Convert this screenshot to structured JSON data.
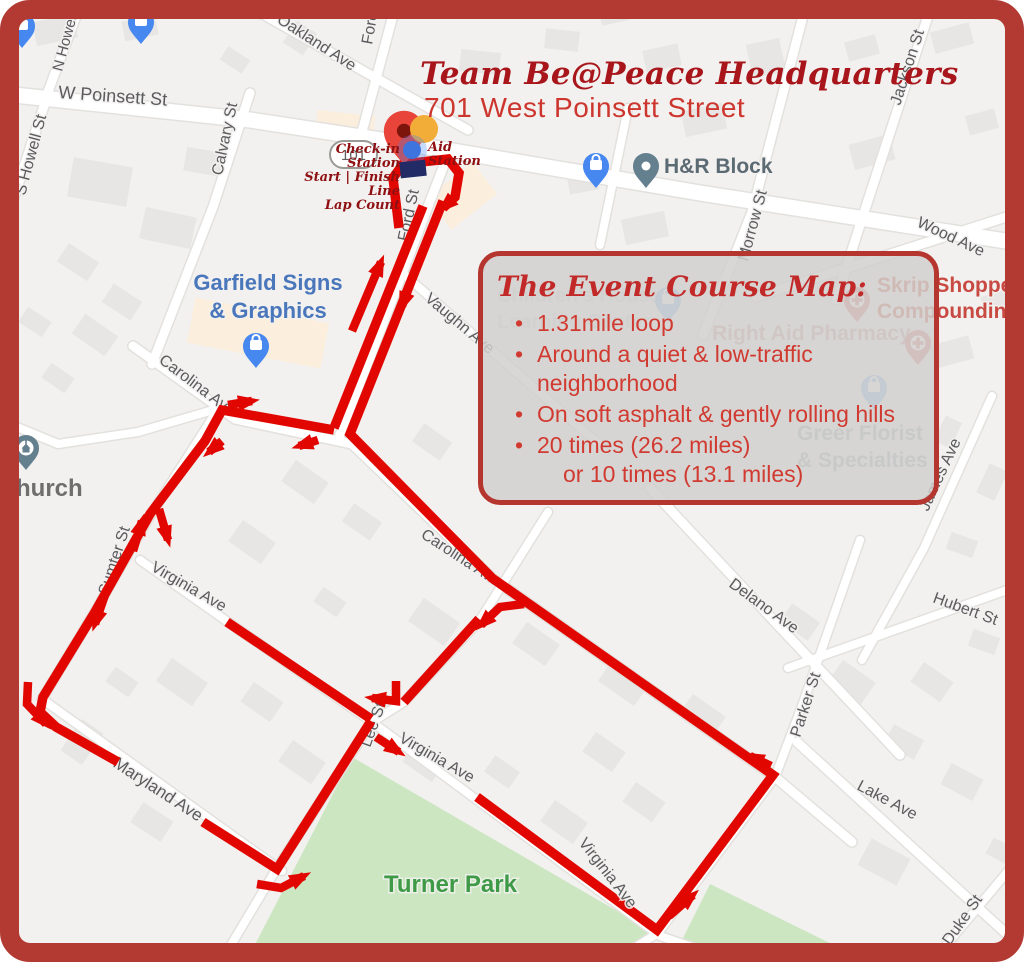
{
  "frame": {
    "border_color": "#b23a32"
  },
  "header": {
    "title": "Team Be@Peace Headquarters",
    "subtitle": "701 West Poinsett Street"
  },
  "start_area": {
    "aid_station_lines": [
      "Aid",
      "Station"
    ],
    "checkin_lines": [
      "Check-in Station",
      "Start | Finish Line",
      "Lap Count"
    ]
  },
  "course_box": {
    "title": "The Event Course Map:",
    "bullets": [
      {
        "text": "1.31mile loop"
      },
      {
        "text": "Around a quiet & low-traffic neighborhood"
      },
      {
        "text": "On soft asphalt & gently rolling hills"
      },
      {
        "text": "20 times (26.2 miles)",
        "cont": "or 10 times (13.1 miles)"
      }
    ],
    "accent_color": "#b5362f",
    "text_color": "#d13a30"
  },
  "map": {
    "background": "#f2f1ef",
    "route_color": "#e10600",
    "route_shield": "101",
    "park_color": "#cbe6c1",
    "street_labels": [
      {
        "t": "W Poinsett St",
        "x": 58,
        "y": 98,
        "r": 4,
        "s": 18
      },
      {
        "t": "Oakland Ave",
        "x": 276,
        "y": 22,
        "r": 33,
        "s": 16
      },
      {
        "t": "Fore",
        "x": 372,
        "y": 45,
        "r": -80,
        "s": 16
      },
      {
        "t": "N Howell",
        "x": 62,
        "y": 72,
        "r": -75,
        "s": 15
      },
      {
        "t": "S Howell St",
        "x": 25,
        "y": 196,
        "r": -75,
        "s": 16
      },
      {
        "t": "Calvary St",
        "x": 222,
        "y": 176,
        "r": -78,
        "s": 16
      },
      {
        "t": "Jackson St",
        "x": 900,
        "y": 106,
        "r": -72,
        "s": 16
      },
      {
        "t": "Wood Ave",
        "x": 916,
        "y": 226,
        "r": 25,
        "s": 16
      },
      {
        "t": "Morrow St",
        "x": 748,
        "y": 262,
        "r": -75,
        "s": 16
      },
      {
        "t": "Ford St",
        "x": 408,
        "y": 242,
        "r": -78,
        "s": 16
      },
      {
        "t": "Vaughn Ave",
        "x": 424,
        "y": 300,
        "r": 40,
        "s": 16
      },
      {
        "t": "Carolina Ave",
        "x": 158,
        "y": 362,
        "r": 37,
        "s": 16
      },
      {
        "t": "Carolina Ave",
        "x": 420,
        "y": 537,
        "r": 33,
        "s": 16
      },
      {
        "t": "Sumter St",
        "x": 108,
        "y": 596,
        "r": -72,
        "s": 16
      },
      {
        "t": "Virginia Ave",
        "x": 150,
        "y": 570,
        "r": 30,
        "s": 16
      },
      {
        "t": "Virginia Ave",
        "x": 398,
        "y": 741,
        "r": 30,
        "s": 16
      },
      {
        "t": "Virginia Ave",
        "x": 578,
        "y": 843,
        "r": 52,
        "s": 16,
        "top": true
      },
      {
        "t": "Lee St",
        "x": 370,
        "y": 748,
        "r": -70,
        "s": 16
      },
      {
        "t": "Maryland Ave",
        "x": 112,
        "y": 766,
        "r": 33,
        "s": 17
      },
      {
        "t": "Delano Ave",
        "x": 728,
        "y": 586,
        "r": 36,
        "s": 16
      },
      {
        "t": "Hubert St",
        "x": 932,
        "y": 602,
        "r": 20,
        "s": 16
      },
      {
        "t": "Parker St",
        "x": 800,
        "y": 738,
        "r": -72,
        "s": 16
      },
      {
        "t": "Lake Ave",
        "x": 856,
        "y": 789,
        "r": 28,
        "s": 16
      },
      {
        "t": "Duke St",
        "x": 950,
        "y": 946,
        "r": -55,
        "s": 16
      },
      {
        "t": "James Ave",
        "x": 928,
        "y": 512,
        "r": -65,
        "s": 16
      }
    ],
    "poi_labels": [
      {
        "name": "garfield-signs",
        "lines": [
          "Garfield Signs",
          "& Graphics"
        ],
        "x": 268,
        "y": 290,
        "s": 22,
        "c": "#4a77bb",
        "align": "middle",
        "lh": 28
      },
      {
        "name": "hr-block",
        "lines": [
          "H&R Block"
        ],
        "x": 664,
        "y": 173,
        "s": 21,
        "c": "#5c6a74"
      },
      {
        "name": "church",
        "lines": [
          "hurch"
        ],
        "x": 16,
        "y": 496,
        "s": 24,
        "c": "#6e6e6e"
      },
      {
        "name": "turner-park",
        "lines": [
          "Turner Park"
        ],
        "x": 384,
        "y": 892,
        "s": 24,
        "c": "#3f9a47"
      },
      {
        "name": "skrip-shoppe",
        "lines": [
          "Skrip Shoppe",
          "Compounding"
        ],
        "x": 877,
        "y": 292,
        "s": 21,
        "c": "#c94a43",
        "lh": 26
      },
      {
        "name": "right-aid",
        "lines": [
          "Right Aid Pharmacy"
        ],
        "x": 712,
        "y": 340,
        "s": 21,
        "c": "#c5908b",
        "o": 0.85
      },
      {
        "name": "greer-florist",
        "lines": [
          "Greer Florist",
          "& Specialties"
        ],
        "x": 797,
        "y": 440,
        "s": 21,
        "c": "#9aa6b4",
        "lh": 27
      },
      {
        "name": "learning-center",
        "lines": [
          "Children's House",
          "Learning Center"
        ],
        "x": 497,
        "y": 302,
        "s": 20,
        "c": "#b6bfc9",
        "o": 0.5,
        "lh": 26
      }
    ],
    "pins": [
      {
        "k": "bag",
        "x": 22,
        "y": 48,
        "c": "#4687f0"
      },
      {
        "k": "bag",
        "x": 141,
        "y": 44,
        "c": "#4687f0"
      },
      {
        "k": "bag",
        "x": 596,
        "y": 188,
        "c": "#4687f0"
      },
      {
        "k": "bag",
        "x": 256,
        "y": 368,
        "c": "#4687f0"
      },
      {
        "k": "bag",
        "x": 668,
        "y": 322,
        "c": "#4687f0",
        "o": 0.6
      },
      {
        "k": "bag",
        "x": 874,
        "y": 410,
        "c": "#4687f0",
        "o": 0.6
      },
      {
        "k": "dot",
        "x": 646,
        "y": 188,
        "c": "#64808f"
      },
      {
        "k": "church",
        "x": 26,
        "y": 470,
        "c": "#64808f"
      },
      {
        "k": "cross",
        "x": 857,
        "y": 322,
        "c": "#d4544e",
        "o": 0.8
      },
      {
        "k": "cross",
        "x": 918,
        "y": 365,
        "c": "#d4544e",
        "o": 0.8
      },
      {
        "k": "dest",
        "x": 404,
        "y": 165,
        "c": "#e8443a",
        "sc": 1.55
      }
    ],
    "roads": [
      {
        "pts": [
          [
            14,
            95
          ],
          [
            250,
            120
          ],
          [
            447,
            150
          ],
          [
            700,
            193
          ],
          [
            1012,
            242
          ]
        ],
        "w": 15
      },
      {
        "pts": [
          [
            238,
            0
          ],
          [
            335,
            55
          ],
          [
            468,
            130
          ]
        ],
        "w": 9
      },
      {
        "pts": [
          [
            397,
            0
          ],
          [
            362,
            132
          ]
        ],
        "w": 9
      },
      {
        "pts": [
          [
            82,
            0
          ],
          [
            45,
            100
          ]
        ],
        "w": 9
      },
      {
        "pts": [
          [
            46,
            100
          ],
          [
            8,
            215
          ],
          [
            0,
            262
          ]
        ],
        "w": 9
      },
      {
        "pts": [
          [
            250,
            93
          ],
          [
            213,
            207
          ],
          [
            152,
            364
          ]
        ],
        "w": 9
      },
      {
        "pts": [
          [
            802,
            20
          ],
          [
            752,
            212
          ],
          [
            703,
            335
          ]
        ],
        "w": 9
      },
      {
        "pts": [
          [
            928,
            16
          ],
          [
            860,
            225
          ],
          [
            836,
            300
          ]
        ],
        "w": 9
      },
      {
        "pts": [
          [
            756,
            297
          ],
          [
            1022,
            212
          ]
        ],
        "w": 9
      },
      {
        "pts": [
          [
            449,
            152
          ],
          [
            338,
            440
          ]
        ],
        "w": 9
      },
      {
        "pts": [
          [
            399,
            270
          ],
          [
            600,
            445
          ]
        ],
        "w": 8
      },
      {
        "pts": [
          [
            628,
            108
          ],
          [
            600,
            245
          ]
        ],
        "w": 8
      },
      {
        "pts": [
          [
            133,
            346
          ],
          [
            235,
            419
          ],
          [
            352,
            444
          ],
          [
            492,
            578
          ],
          [
            775,
            777
          ],
          [
            852,
            842
          ]
        ],
        "w": 9
      },
      {
        "pts": [
          [
            220,
            406
          ],
          [
            150,
            516
          ],
          [
            94,
            613
          ],
          [
            42,
            699
          ]
        ],
        "w": 8
      },
      {
        "pts": [
          [
            140,
            560
          ],
          [
            228,
            622
          ],
          [
            372,
            722
          ]
        ],
        "w": 8
      },
      {
        "pts": [
          [
            372,
            722
          ],
          [
            660,
            936
          ],
          [
            735,
            962
          ]
        ],
        "w": 8
      },
      {
        "pts": [
          [
            42,
            699
          ],
          [
            282,
            871
          ]
        ],
        "w": 8
      },
      {
        "pts": [
          [
            548,
            512
          ],
          [
            480,
            620
          ],
          [
            404,
            702
          ],
          [
            372,
            722
          ],
          [
            277,
            868
          ],
          [
            228,
            950
          ]
        ],
        "w": 8
      },
      {
        "pts": [
          [
            650,
            488
          ],
          [
            775,
            622
          ],
          [
            900,
            755
          ]
        ],
        "w": 9
      },
      {
        "pts": [
          [
            788,
            668
          ],
          [
            1024,
            584
          ]
        ],
        "w": 8
      },
      {
        "pts": [
          [
            992,
            396
          ],
          [
            924,
            548
          ],
          [
            862,
            660
          ]
        ],
        "w": 8
      },
      {
        "pts": [
          [
            860,
            540
          ],
          [
            802,
            706
          ],
          [
            775,
            777
          ],
          [
            658,
            933
          ],
          [
            612,
            962
          ]
        ],
        "w": 8
      },
      {
        "pts": [
          [
            797,
            742
          ],
          [
            1022,
            948
          ]
        ],
        "w": 9
      },
      {
        "pts": [
          [
            1024,
            852
          ],
          [
            932,
            962
          ]
        ],
        "w": 8
      },
      {
        "pts": [
          [
            0,
            420
          ],
          [
            58,
            444
          ],
          [
            138,
            432
          ],
          [
            220,
            408
          ]
        ],
        "w": 8
      }
    ],
    "parks": [
      [
        [
          352,
          757
        ],
        [
          660,
          936
        ],
        [
          622,
          962
        ],
        [
          246,
          962
        ]
      ],
      [
        [
          682,
          940
        ],
        [
          710,
          884
        ],
        [
          848,
          952
        ],
        [
          848,
          962
        ],
        [
          662,
          962
        ]
      ]
    ],
    "route_segments": [
      {
        "pts": [
          [
            399,
            228
          ],
          [
            393,
            178
          ],
          [
            403,
            164
          ],
          [
            448,
            159
          ],
          [
            459,
            173
          ],
          [
            455,
            197
          ],
          [
            443,
            208
          ]
        ],
        "arrow": true
      },
      {
        "pts": [
          [
            443,
            201
          ],
          [
            350,
            434
          ],
          [
            492,
            578
          ],
          [
            773,
            775
          ],
          [
            657,
            930
          ],
          [
            477,
            797
          ]
        ]
      },
      {
        "pts": [
          [
            423,
            206
          ],
          [
            334,
            428
          ]
        ]
      },
      {
        "pts": [
          [
            334,
            430
          ],
          [
            222,
            410
          ],
          [
            205,
            441
          ],
          [
            150,
            514
          ],
          [
            95,
            612
          ],
          [
            43,
            697
          ],
          [
            40,
            712
          ],
          [
            56,
            727
          ],
          [
            118,
            762
          ]
        ]
      },
      {
        "pts": [
          [
            203,
            822
          ],
          [
            277,
            869
          ],
          [
            371,
            721
          ]
        ]
      },
      {
        "pts": [
          [
            227,
            622
          ],
          [
            371,
            719
          ]
        ]
      },
      {
        "pts": [
          [
            479,
            619
          ],
          [
            404,
            702
          ]
        ]
      },
      {
        "pts": [
          [
            396,
            681
          ],
          [
            396,
            701
          ],
          [
            372,
            698
          ]
        ],
        "arrow": true,
        "w": 8.5
      },
      {
        "pts": [
          [
            376,
            737
          ],
          [
            399,
            752
          ]
        ],
        "arrow": true,
        "w": 8.5
      },
      {
        "pts": [
          [
            352,
            331
          ],
          [
            381,
            262
          ]
        ],
        "arrow": true,
        "w": 8.5
      },
      {
        "pts": [
          [
            419,
            261
          ],
          [
            402,
            306
          ]
        ],
        "arrow": true,
        "w": 8.5
      },
      {
        "pts": [
          [
            318,
            440
          ],
          [
            299,
            446
          ]
        ],
        "arrow": true,
        "w": 8.5
      },
      {
        "pts": [
          [
            228,
            405
          ],
          [
            252,
            401
          ]
        ],
        "arrow": true,
        "w": 8.5
      },
      {
        "pts": [
          [
            222,
            441
          ],
          [
            209,
            452
          ]
        ],
        "arrow": true,
        "w": 8.5
      },
      {
        "pts": [
          [
            133,
            551
          ],
          [
            142,
            521
          ]
        ],
        "arrow": true,
        "w": 8.5
      },
      {
        "pts": [
          [
            159,
            509
          ],
          [
            168,
            540
          ]
        ],
        "arrow": true,
        "w": 8.5
      },
      {
        "pts": [
          [
            107,
            589
          ],
          [
            95,
            624
          ]
        ],
        "arrow": true,
        "w": 8.5
      },
      {
        "pts": [
          [
            28,
            682
          ],
          [
            27,
            704
          ],
          [
            46,
            724
          ]
        ],
        "arrow": true,
        "w": 8.5
      },
      {
        "pts": [
          [
            257,
            884
          ],
          [
            281,
            888
          ],
          [
            304,
            876
          ]
        ],
        "arrow": true,
        "w": 8.5
      },
      {
        "pts": [
          [
            669,
            916
          ],
          [
            693,
            895
          ]
        ],
        "arrow": true,
        "w": 8.5
      },
      {
        "pts": [
          [
            771,
            766
          ],
          [
            750,
            756
          ]
        ],
        "arrow": true,
        "w": 8.5
      },
      {
        "pts": [
          [
            524,
            604
          ],
          [
            500,
            607
          ],
          [
            481,
            625
          ]
        ],
        "arrow": true,
        "w": 8.5
      }
    ]
  }
}
